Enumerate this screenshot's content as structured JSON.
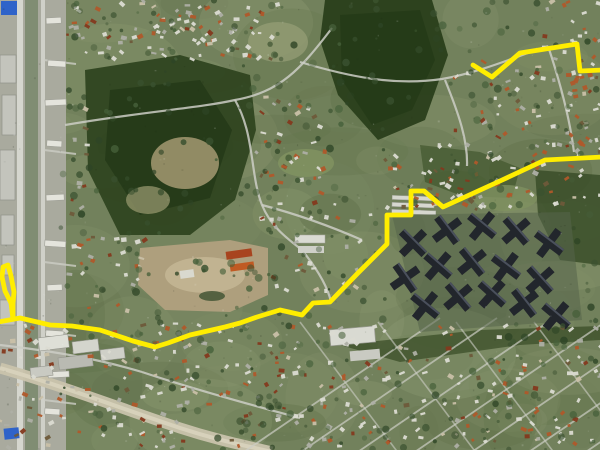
{
  "canvas": {
    "width": 600,
    "height": 450
  },
  "map": {
    "kind": "satellite-aerial-photo-with-route-overlay",
    "visible_text": "none",
    "route": {
      "color": "#ffed00",
      "stroke_width": 4.8,
      "segments": [
        {
          "name": "route-north-branch",
          "points": [
            [
              473,
              65
            ],
            [
              492,
              77
            ],
            [
              520,
              53
            ],
            [
              577,
              44
            ],
            [
              580,
              71
            ],
            [
              602,
              70
            ]
          ]
        },
        {
          "name": "route-main",
          "points": [
            [
              602,
              157
            ],
            [
              545,
              160
            ],
            [
              500,
              181
            ],
            [
              443,
              207
            ],
            [
              424,
              191
            ],
            [
              411,
              191
            ],
            [
              411,
              215
            ],
            [
              387,
              215
            ],
            [
              387,
              244
            ],
            [
              357,
              274
            ],
            [
              330,
              302
            ],
            [
              313,
              303
            ],
            [
              302,
              315
            ],
            [
              280,
              310
            ],
            [
              257,
              317
            ],
            [
              240,
              323
            ],
            [
              225,
              327
            ],
            [
              190,
              335
            ],
            [
              168,
              343
            ],
            [
              155,
              347
            ],
            [
              133,
              341
            ],
            [
              100,
              330
            ],
            [
              72,
              326
            ],
            [
              50,
              325
            ],
            [
              20,
              318
            ],
            [
              -2,
              322
            ]
          ]
        },
        {
          "name": "route-west-spur-loop",
          "points": [
            [
              13,
              319
            ],
            [
              11,
              303
            ],
            [
              5,
              291
            ],
            [
              2,
              277
            ],
            [
              3,
              267
            ],
            [
              8,
              265
            ],
            [
              11,
              276
            ],
            [
              14,
              292
            ],
            [
              13,
              303
            ],
            [
              13,
              319
            ]
          ]
        }
      ]
    },
    "palette": {
      "terrain_green": "#72815c",
      "terrain_green_light": "#86946b",
      "forest_dark": "#2f4420",
      "forest_darker": "#253a18",
      "field_tan": "#b1a07e",
      "field_tan_light": "#c6b896",
      "road_light": "#cdcec5",
      "urban_gray": "#a9aa9e",
      "building_white": "#dedfd7",
      "building_gray": "#b4b5ab",
      "roof_red": "#a8512b",
      "roof_dark_red": "#84391d",
      "highrise_dark": "#22262c",
      "river_road": "#c9c3ac",
      "blue_roof": "#2f63c9"
    }
  }
}
